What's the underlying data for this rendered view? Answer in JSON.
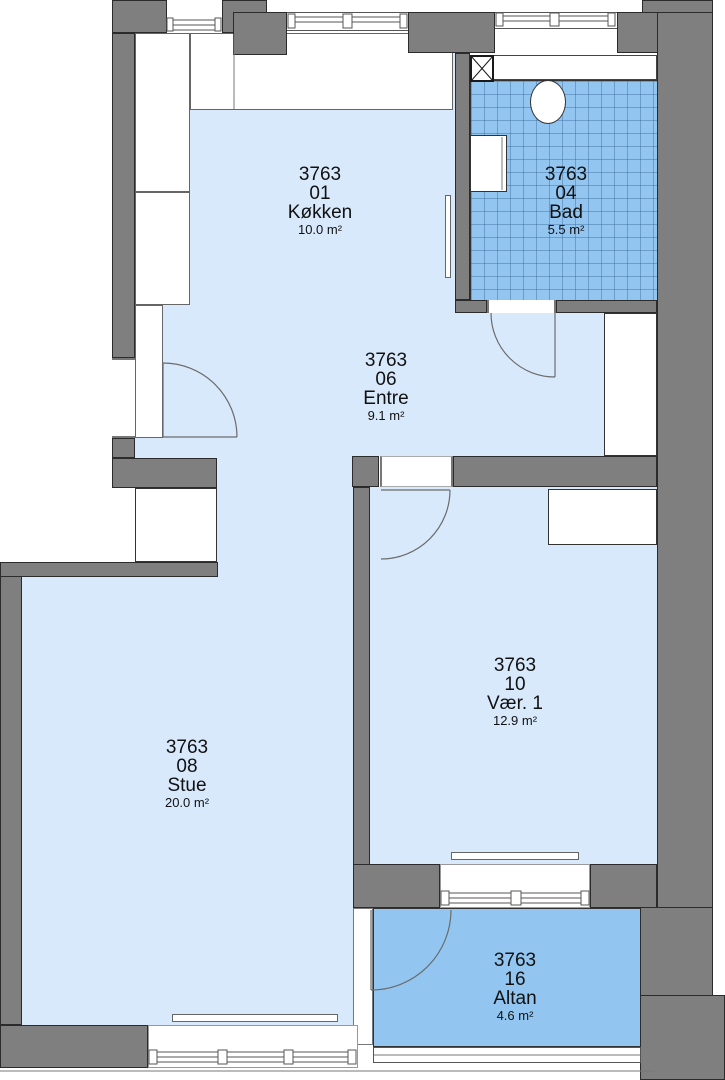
{
  "floorplan": {
    "unit_id": "3763",
    "rooms": [
      {
        "id": "3763",
        "number": "01",
        "name": "Køkken",
        "area": "10.0 m²"
      },
      {
        "id": "3763",
        "number": "04",
        "name": "Bad",
        "area": "5.5 m²"
      },
      {
        "id": "3763",
        "number": "06",
        "name": "Entre",
        "area": "9.1 m²"
      },
      {
        "id": "3763",
        "number": "08",
        "name": "Stue",
        "area": "20.0 m²"
      },
      {
        "id": "3763",
        "number": "10",
        "name": "Vær. 1",
        "area": "12.9 m²"
      },
      {
        "id": "3763",
        "number": "16",
        "name": "Altan",
        "area": "4.6 m²"
      }
    ],
    "fixtures": [
      "toilet",
      "sink-vanity",
      "vent-shaft",
      "wardrobe",
      "closet",
      "radiator",
      "kitchen-counter",
      "balcony-railing",
      "door-swing",
      "window"
    ],
    "colors": {
      "wall": "#7f7f7f",
      "room_floor": "#d9e9fc",
      "wet_floor": "#92c5ef",
      "tile_line": "#32608f",
      "outline": "#2b2b2b",
      "background": "#ffffff"
    }
  }
}
